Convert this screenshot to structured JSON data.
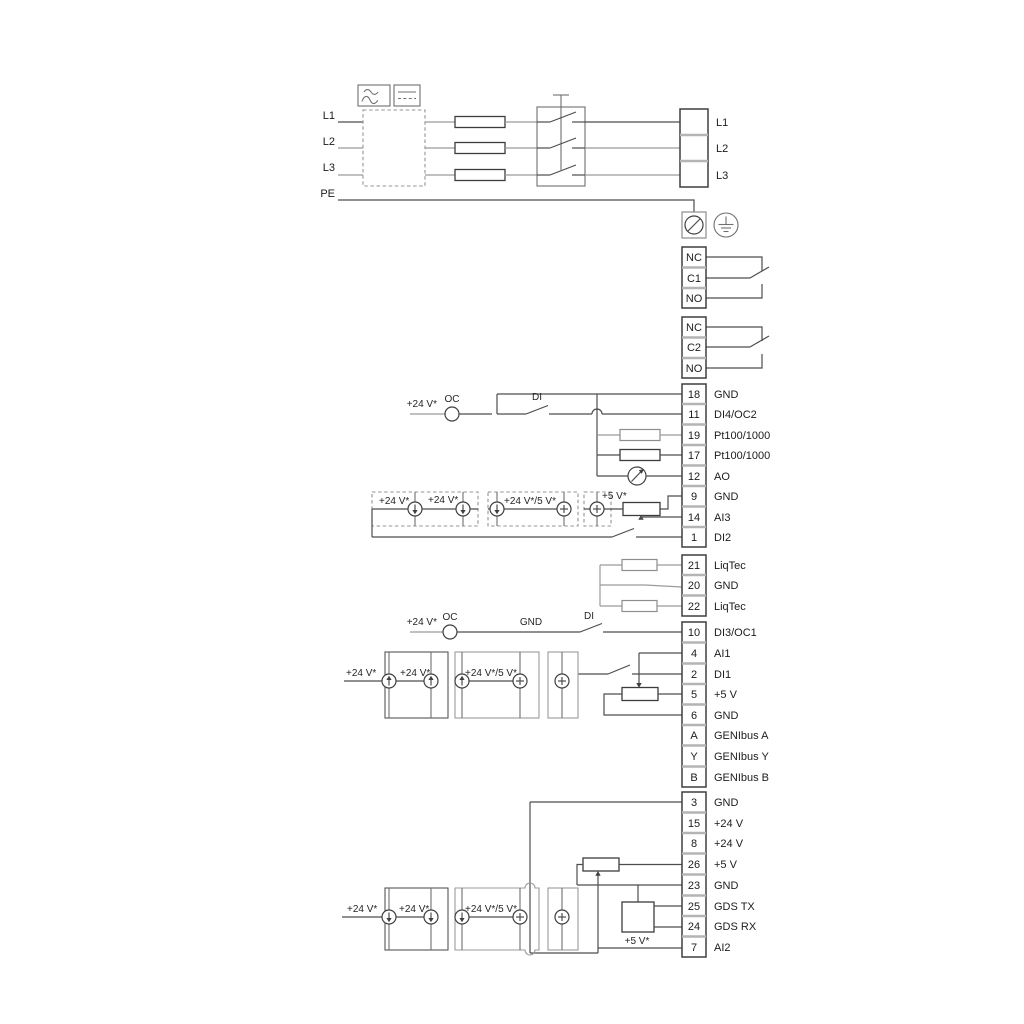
{
  "colors": {
    "wire": "#4d4d4d",
    "wire_light": "#9b9b9b",
    "text": "#1c1c1c",
    "divider": "#b4b4b4",
    "background": "#ffffff"
  },
  "power_in": {
    "l1": "L1",
    "l2": "L2",
    "l3": "L3",
    "pe": "PE"
  },
  "power_out": [
    "L1",
    "L2",
    "L3"
  ],
  "relay1": [
    "NC",
    "C1",
    "NO"
  ],
  "relay2": [
    "NC",
    "C2",
    "NO"
  ],
  "io_a": [
    {
      "n": "18",
      "l": "GND"
    },
    {
      "n": "11",
      "l": "DI4/OC2"
    },
    {
      "n": "19",
      "l": "Pt100/1000"
    },
    {
      "n": "17",
      "l": "Pt100/1000"
    },
    {
      "n": "12",
      "l": "AO"
    },
    {
      "n": "9",
      "l": "GND"
    },
    {
      "n": "14",
      "l": "AI3"
    },
    {
      "n": "1",
      "l": "DI2"
    }
  ],
  "liqtec": [
    {
      "n": "21",
      "l": "LiqTec"
    },
    {
      "n": "20",
      "l": "GND"
    },
    {
      "n": "22",
      "l": "LiqTec"
    }
  ],
  "io_b": [
    {
      "n": "10",
      "l": "DI3/OC1"
    },
    {
      "n": "4",
      "l": "AI1"
    },
    {
      "n": "2",
      "l": "DI1"
    },
    {
      "n": "5",
      "l": "+5 V"
    },
    {
      "n": "6",
      "l": "GND"
    },
    {
      "n": "A",
      "l": "GENIbus A"
    },
    {
      "n": "Y",
      "l": "GENIbus Y"
    },
    {
      "n": "B",
      "l": "GENIbus B"
    }
  ],
  "io_c": [
    {
      "n": "3",
      "l": "GND"
    },
    {
      "n": "15",
      "l": "+24 V"
    },
    {
      "n": "8",
      "l": "+24 V"
    },
    {
      "n": "26",
      "l": "+5 V"
    },
    {
      "n": "23",
      "l": "GND"
    },
    {
      "n": "25",
      "l": "GDS TX"
    },
    {
      "n": "24",
      "l": "GDS RX"
    },
    {
      "n": "7",
      "l": "AI2"
    }
  ],
  "ann": {
    "di4": {
      "v24": "+24 V*",
      "oc": "OC",
      "di": "DI"
    },
    "ai3": {
      "v24a": "+24 V*",
      "v24b": "+24 V*",
      "v245": "+24 V*/5 V*",
      "v5": "+5 V*"
    },
    "di3": {
      "v24": "+24 V*",
      "oc": "OC",
      "gnd": "GND",
      "di": "DI"
    },
    "ai1": {
      "v24a": "+24 V*",
      "v24b": "+24 V*",
      "v245": "+24 V*/5 V*"
    },
    "ai2": {
      "v24a": "+24 V*",
      "v24b": "+24 V*",
      "v245": "+24 V*/5 V*",
      "v5": "+5 V*"
    }
  }
}
